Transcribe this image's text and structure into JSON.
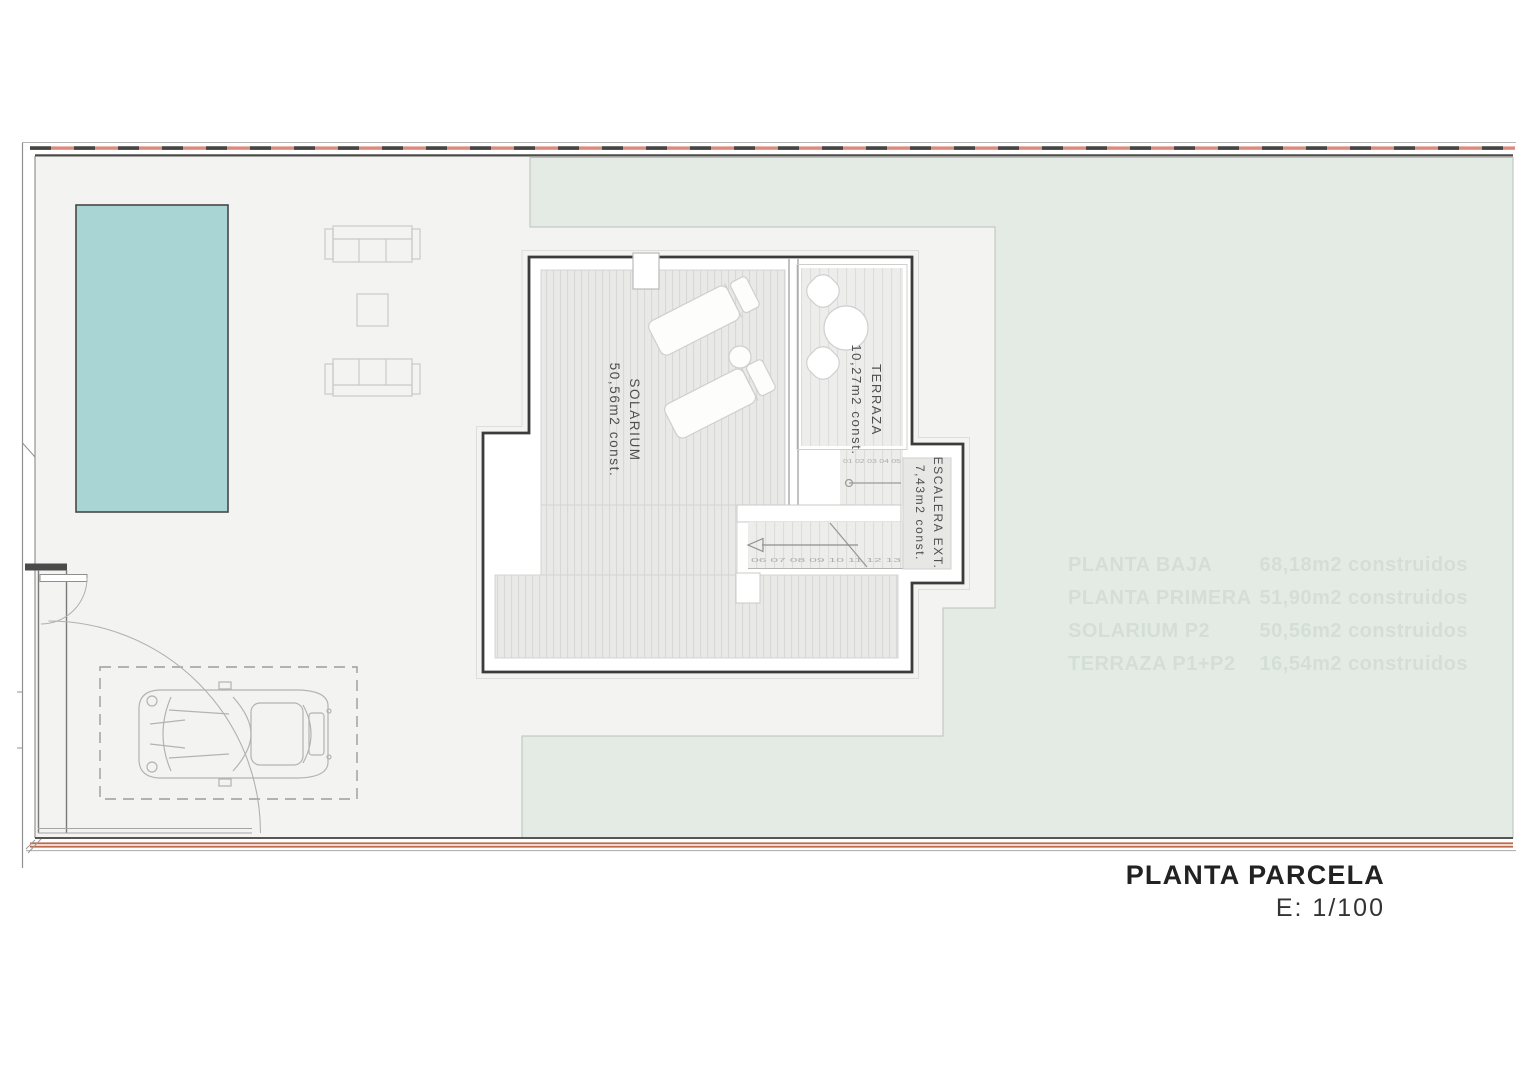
{
  "document": {
    "title": "PLANTA PARCELA",
    "scale_label": "E: 1/100"
  },
  "plan": {
    "rooms": [
      {
        "id": "solarium",
        "label": "SOLARIUM",
        "area": "50,56m2 const."
      },
      {
        "id": "terraza",
        "label": "TERRAZA",
        "area": "10,27m2 const."
      },
      {
        "id": "escalera",
        "label": "ESCALERA EXT.",
        "area": "7,43m2 const."
      }
    ],
    "stairs": {
      "upper_step_numbers": "01 02 03 04 05",
      "lower_step_numbers": "06 07 08 09 10 11 12 13"
    }
  },
  "watermark_table": {
    "rows": [
      {
        "label": "PLANTA BAJA",
        "value": "68,18m2 construidos"
      },
      {
        "label": "PLANTA PRIMERA",
        "value": "51,90m2 construidos"
      },
      {
        "label": "SOLARIUM P2",
        "value": "50,56m2 construidos"
      },
      {
        "label": "TERRAZA P1+P2",
        "value": "16,54m2 construidos"
      }
    ]
  },
  "colors": {
    "pool": "#a9d6d4",
    "lawn": "#e4ebe5",
    "paving": "#f3f4f2",
    "boundary_red": "#dd8a7e",
    "boundary_orange": "#c06a4d",
    "outline": "#3b3b3b"
  }
}
